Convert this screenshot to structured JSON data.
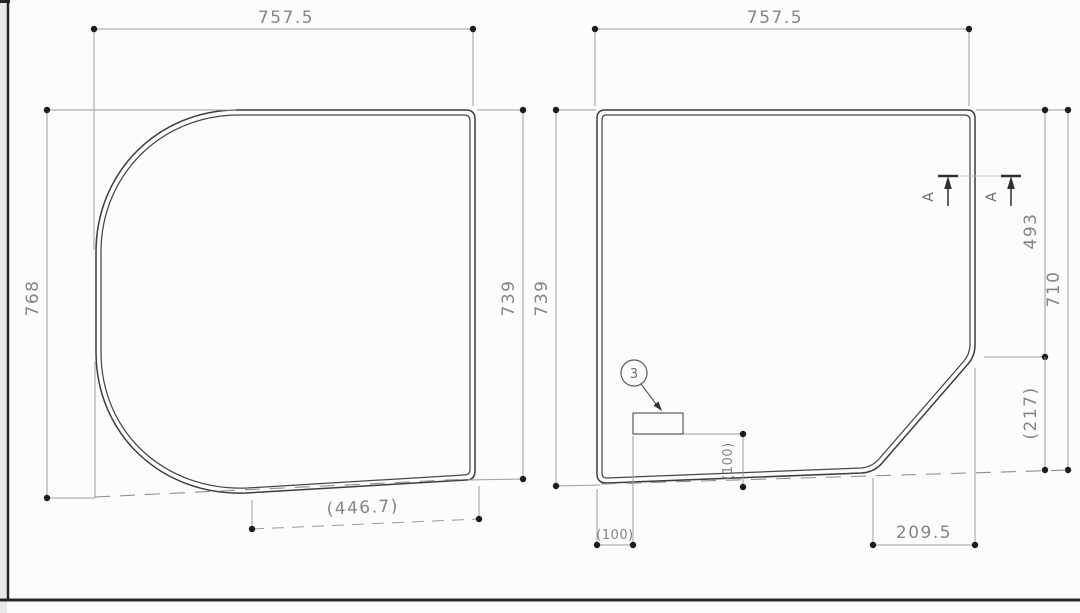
{
  "drawing": {
    "type": "technical-dimension-drawing",
    "description": "Two outline views of bathtub lid panels with dimension annotations"
  },
  "colors": {
    "background": "#fcfcfc",
    "outline": "#3d3d3d",
    "dimension_line": "#9e9e9e",
    "dimension_text": "#858585",
    "border_dark": "#262626",
    "margin_strip": "#e9e9e9"
  },
  "left_view": {
    "width_top": "757.5",
    "height_left": "768",
    "height_right": "739",
    "width_bottom": "(446.7)"
  },
  "right_view": {
    "width_top": "757.5",
    "height_left": "739",
    "height_right_upper": "493",
    "height_right_lower": "(217)",
    "height_right_total": "710",
    "width_bottom_left": "(100)",
    "width_bottom_right": "209.5",
    "height_inner": "(100)",
    "callout_number": "3",
    "section_label_left": "A",
    "section_label_right": "A"
  }
}
